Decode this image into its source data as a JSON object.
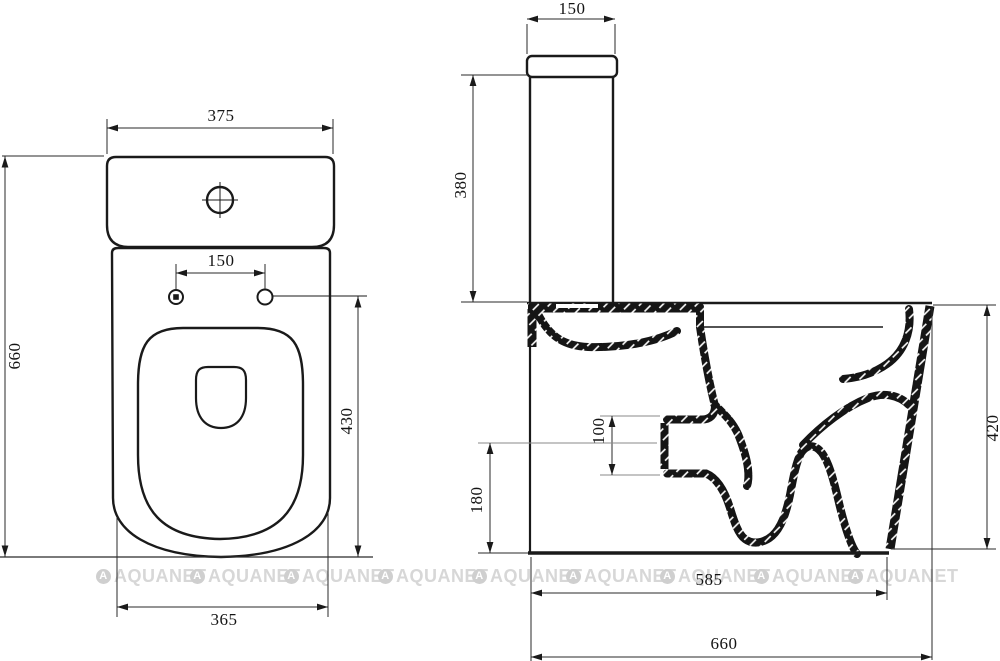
{
  "front_view": {
    "width_top": "375",
    "hole_spacing": "150",
    "height_total": "660",
    "seat_hole_height": "430",
    "width_base": "365"
  },
  "side_view": {
    "lid_depth": "150",
    "tank_height": "380",
    "outlet_size": "100",
    "outlet_center_height": "180",
    "bowl_height": "420",
    "depth_base": "585",
    "depth_total": "660"
  },
  "watermark": {
    "brand": "AQUANET",
    "logo_letter": "A"
  },
  "colors": {
    "line": "#1a1a1a",
    "watermark_text": "#d7d7d7",
    "watermark_logo": "#cfcfcf",
    "background": "#ffffff"
  }
}
